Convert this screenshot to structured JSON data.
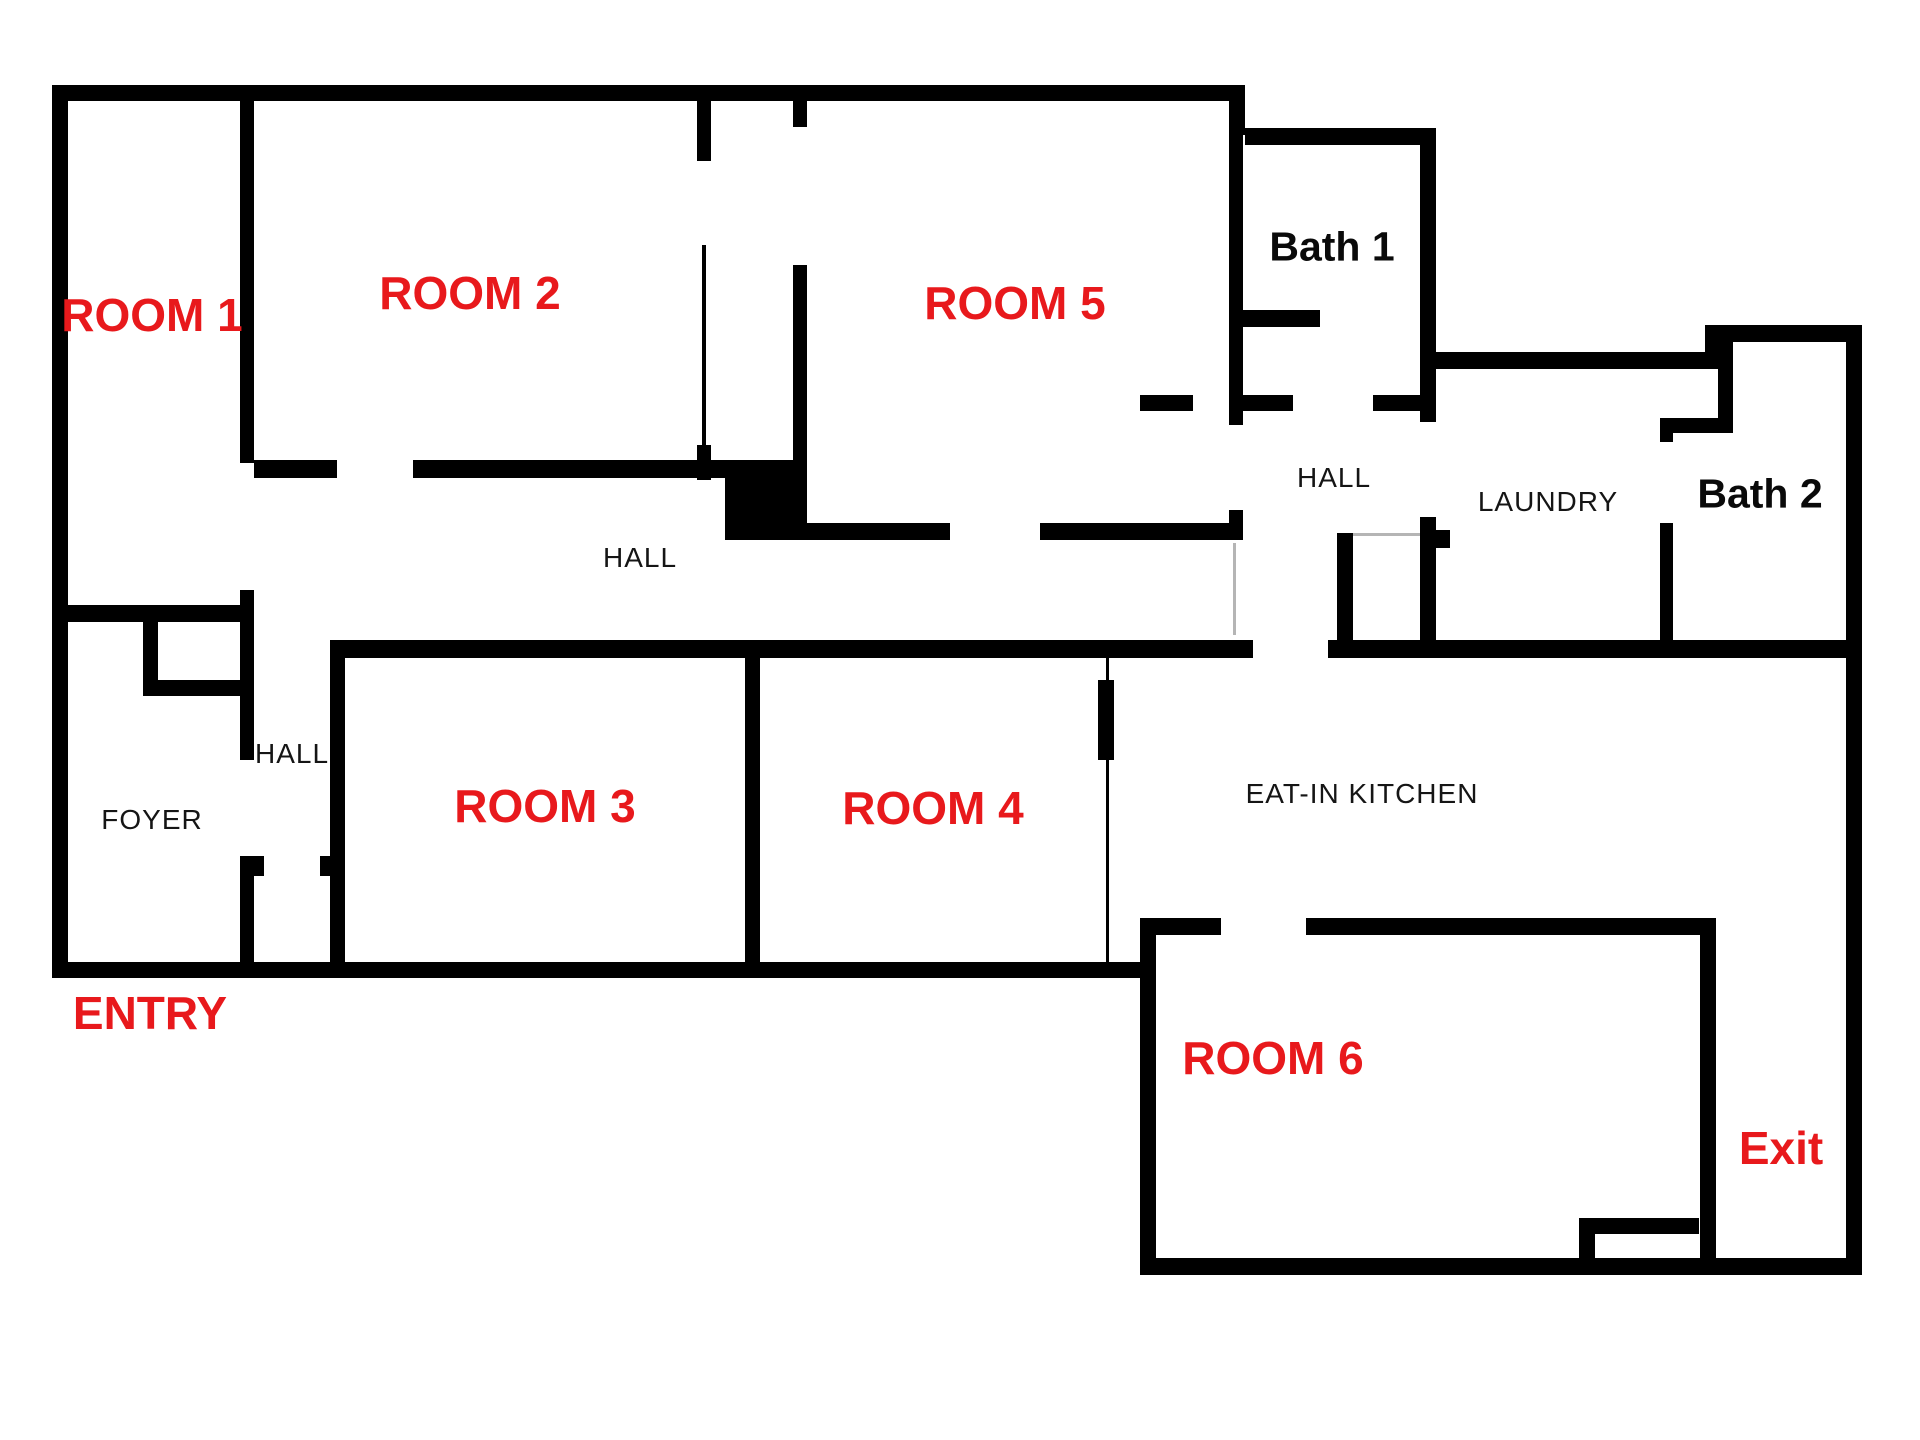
{
  "title": "Floor plan",
  "colors": {
    "background": "#ffffff",
    "walls": "#000000",
    "room_label": "#e8191c",
    "area_label": "#151515"
  },
  "rooms": {
    "room1": {
      "label": "ROOM 1"
    },
    "room2": {
      "label": "ROOM 2"
    },
    "room3": {
      "label": "ROOM 3"
    },
    "room4": {
      "label": "ROOM 4"
    },
    "room5": {
      "label": "ROOM 5"
    },
    "room6": {
      "label": "ROOM 6"
    },
    "bath1": {
      "label": "Bath 1"
    },
    "bath2": {
      "label": "Bath 2"
    },
    "hall_upper": {
      "label": "HALL"
    },
    "hall_middle": {
      "label": "HALL"
    },
    "hall_lower": {
      "label": "HALL"
    },
    "foyer": {
      "label": "FOYER"
    },
    "laundry": {
      "label": "LAUNDRY"
    },
    "kitchen": {
      "label": "EAT-IN KITCHEN"
    },
    "entry": {
      "label": "ENTRY"
    },
    "exit": {
      "label": "Exit"
    }
  }
}
